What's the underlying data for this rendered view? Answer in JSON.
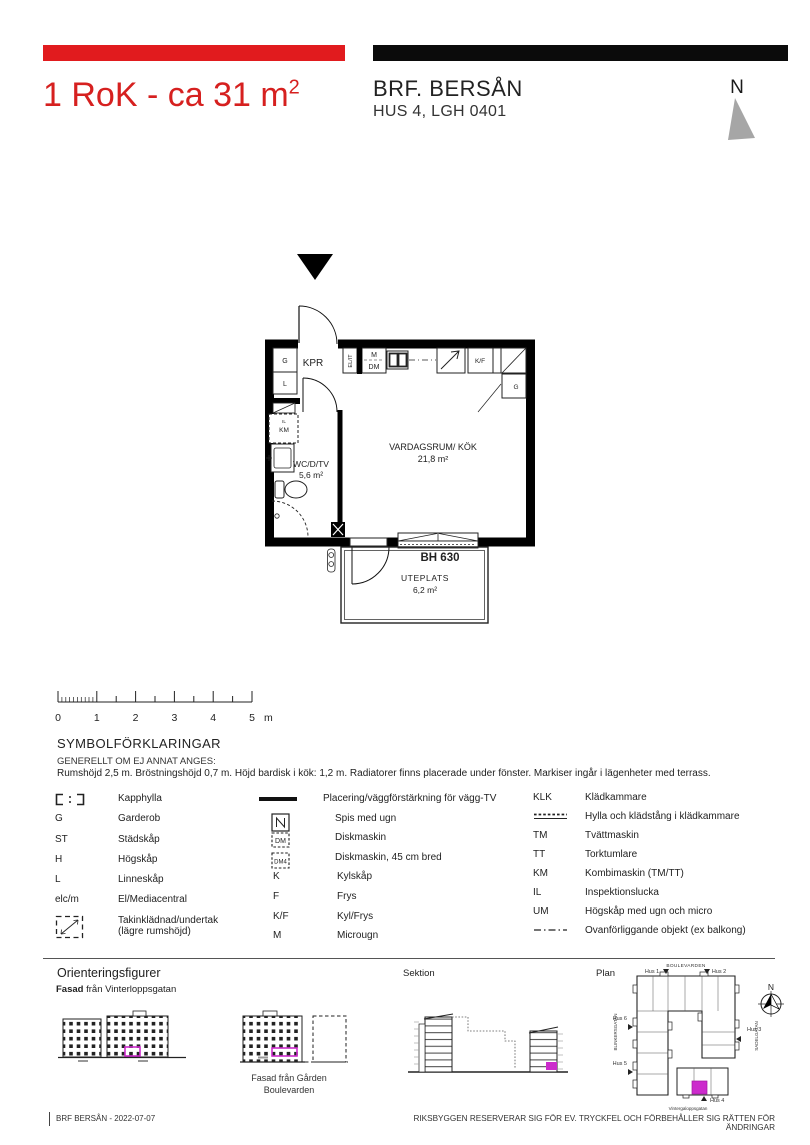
{
  "header": {
    "title": "1 RoK - ca 31  m",
    "title_sup": "2",
    "project": "BRF. BERSÅN",
    "unit": "HUS 4, LGH 0401",
    "compass_n": "N"
  },
  "floorplan": {
    "kpr": "KPR",
    "closet_g": "G",
    "closet_l": "L",
    "el_it": "EL/IT",
    "micro": "M",
    "dm": "DM",
    "kf": "K/F",
    "closet_g2": "G",
    "il": "IL",
    "km": "KM",
    "wc_label": "WC/D/TV",
    "wc_area": "5,6 m²",
    "living_label": "VARDAGSRUM/ KÖK",
    "living_area": "21,8 m²",
    "window_height": "BH 630",
    "terrace_label": "UTEPLATS",
    "terrace_area": "6,2 m²"
  },
  "scalebar": {
    "labels": [
      "0",
      "1",
      "2",
      "3",
      "4",
      "5"
    ],
    "unit": "m"
  },
  "legend": {
    "heading": "SYMBOLFÖRKLARINGAR",
    "subheading": "GENERELLT OM EJ ANNAT ANGES:",
    "note": "Rumshöjd 2,5 m. Bröstningshöjd 0,7 m. Höjd bardisk i kök: 1,2 m. Radiatorer finns placerade under fönster. Markiser ingår i lägenheter med terrass.",
    "col1": [
      {
        "sym": "",
        "label": "Kapphylla"
      },
      {
        "sym": "G",
        "label": "Garderob"
      },
      {
        "sym": "ST",
        "label": "Städskåp"
      },
      {
        "sym": "H",
        "label": "Högskåp"
      },
      {
        "sym": "L",
        "label": "Linneskåp"
      },
      {
        "sym": "elc/m",
        "label": "El/Mediacentral"
      },
      {
        "sym": "",
        "label": "Takinklädnad/undertak",
        "label2": "(lägre rumshöjd)"
      }
    ],
    "col2": [
      {
        "sym": "",
        "label": "Placering/väggförstärkning för vägg-TV"
      },
      {
        "sym": "",
        "label": "Spis med ugn"
      },
      {
        "sym": "DM",
        "label": "Diskmaskin"
      },
      {
        "sym": "DM4",
        "label": "Diskmaskin, 45 cm bred"
      },
      {
        "sym": "K",
        "label": "Kylskåp"
      },
      {
        "sym": "F",
        "label": "Frys"
      },
      {
        "sym": "K/F",
        "label": "Kyl/Frys"
      },
      {
        "sym": "M",
        "label": "Microugn"
      }
    ],
    "col3": [
      {
        "sym": "KLK",
        "label": "Klädkammare"
      },
      {
        "sym": "",
        "label": "Hylla och klädstång i klädkammare"
      },
      {
        "sym": "TM",
        "label": "Tvättmaskin"
      },
      {
        "sym": "TT",
        "label": "Torktumlare"
      },
      {
        "sym": "KM",
        "label": "Kombimaskin (TM/TT)"
      },
      {
        "sym": "IL",
        "label": "Inspektionslucka"
      },
      {
        "sym": "UM",
        "label": "Högskåp med ugn och micro"
      },
      {
        "sym": "",
        "label": "Ovanförliggande objekt (ex  balkong)"
      }
    ]
  },
  "orientation": {
    "heading": "Orienteringsfigurer",
    "fasad1_bold": "Fasad",
    "fasad1_rest": " från Vinterloppsgatan",
    "fasad2_caption1": "Fasad från Gården",
    "fasad2_caption2": "Boulevarden",
    "sektion_label": "Sektion",
    "plan_label": "Plan",
    "streets": {
      "top": "BOULEVARDEN",
      "bottom": "Vintergaloppsgatan",
      "left": "BLINKERSGATAN",
      "right": "SADELGATAN"
    },
    "hus": {
      "h1": "Hus 1",
      "h2": "Hus 2",
      "h3": "Hus 3",
      "h4": "Hus 4",
      "h5": "Hus 5",
      "h6": "Hus 6"
    },
    "compass_n": "N"
  },
  "footer": {
    "left": "BRF BERSÅN - 2022-07-07",
    "right": "RIKSBYGGEN RESERVERAR SIG FÖR EV. TRYCKFEL OCH FÖRBEHÅLLER SIG RÄTTEN FÖR ÄNDRINGAR"
  },
  "colors": {
    "accent_red": "#e11b1e",
    "highlight_magenta": "#cc2bcc",
    "bar_black": "#0b0b0b"
  }
}
